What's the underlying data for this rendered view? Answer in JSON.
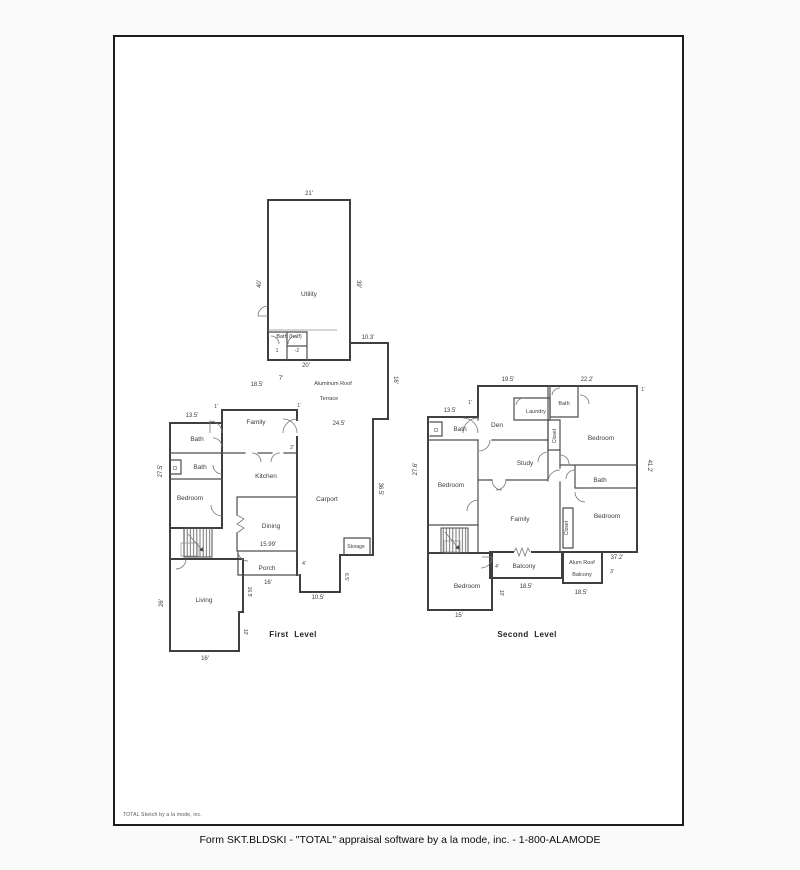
{
  "page": {
    "watermark": "TOTAL Sketch by a la mode, inc.",
    "footer": "Form SKT.BLDSKI - \"TOTAL\" appraisal software by a la mode, inc. - 1-800-ALAMODE"
  },
  "colors": {
    "wall": "#3f3f3f",
    "text": "#3d3d3d",
    "page_border": "#1c1c1c",
    "page_bg": "#ffffff"
  },
  "first_level": {
    "title": "First  Level",
    "rooms": {
      "utility": "Utility",
      "bath_half": "Bath (half)",
      "stall_1": "1",
      "stall_2": "-2",
      "roof_line1": "Aluminum Roof",
      "roof_line2": "Terrace",
      "family": "Family",
      "bath_upper": "Bath",
      "bath_lower": "Bath",
      "closet": "Cl",
      "bedroom": "Bedroom",
      "kitchen": "Kitchen",
      "carport": "Carport",
      "dining": "Dining",
      "porch": "Porch",
      "storage": "Storage",
      "living": "Living"
    },
    "dims": {
      "utility_top": "21'",
      "utility_left": "40'",
      "utility_right": "39'",
      "bath_half_bottom": "20'",
      "step_top": "10.3'",
      "terrace_right": "16'",
      "seven": "7'",
      "family_top": "18.5'",
      "tick_left": "1'",
      "tick_right": "1'",
      "wing_top": "13.5'",
      "wing_left": "27.5'",
      "terrace_width": "24.5'",
      "carport_right": "36.5'",
      "two": "2'",
      "dining_bottom": "15.99'",
      "porch_bottom": "16'",
      "four": "4'",
      "carport_bottom": "10.5'",
      "storage_side": "6.5'",
      "living_left": "26'",
      "living_right_upper": "16.5'",
      "living_right_lower": "10'",
      "living_bottom": "16'"
    }
  },
  "second_level": {
    "title": "Second Level",
    "rooms": {
      "laundry": "Laundry",
      "bath_top": "Bath",
      "closet_cl": "Cl",
      "bath_left": "Bath",
      "den": "Den",
      "closet_upper": "Closet",
      "bedroom_right_upper": "Bedroom",
      "study": "Study",
      "bath_mid": "Bath",
      "bedroom_left": "Bedroom",
      "bedroom_right_lower": "Bedroom",
      "closet_lower": "Closet",
      "family": "Family",
      "bedroom_bottom": "Bedroom",
      "balcony": "Balcony",
      "alum_roof_line1": "Alum Roof",
      "alum_roof_line2": "Balcony"
    },
    "dims": {
      "top_left": "19.5'",
      "top_right": "22.2'",
      "tick_top_left": "1'",
      "tick_top_right": "1'",
      "wing_top": "13.5'",
      "wing_left": "27.6'",
      "right_side": "41.2'",
      "bottom_right": "37.2'",
      "three": "3'",
      "alum_bottom": "18.5'",
      "balcony_bottom": "18.5'",
      "four": "4'",
      "bedroom_left_dim": "22'",
      "bedroom_bottom_dim": "15'",
      "bedroom_right_dim": "10'"
    }
  }
}
